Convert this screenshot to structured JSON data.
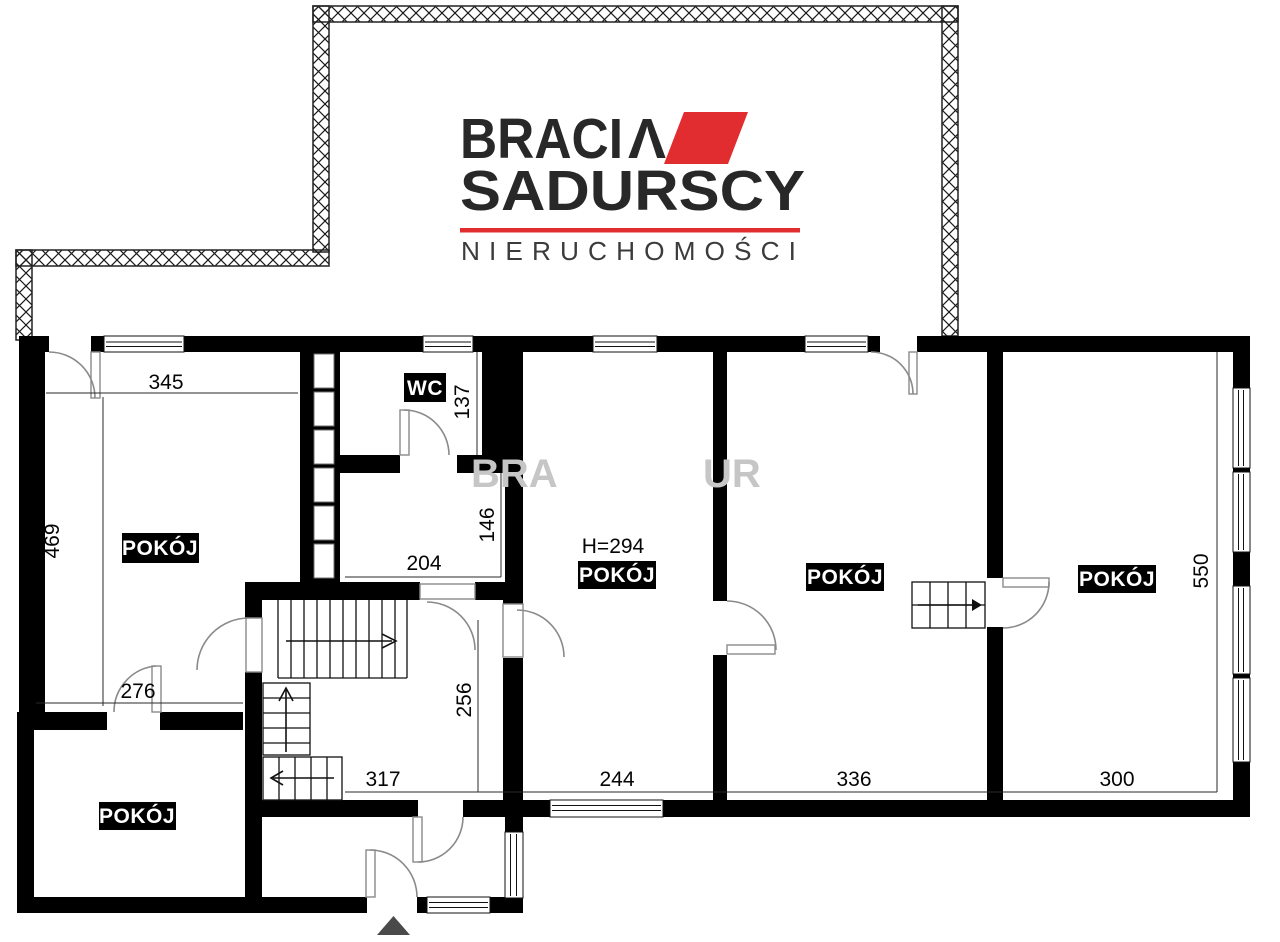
{
  "meta": {
    "wall_color": "#000000",
    "accent_color": "#e22d30",
    "watermark_color": "#c6c6c6",
    "entrance_color": "#4a4a4a",
    "logo_color": "#282828",
    "subtitle_color": "#3b3b3b"
  },
  "logo": {
    "word1": "BRACI",
    "word1_accent": "Λ",
    "word2": "SADURSCY",
    "subtitle": "NIERUCHOMOŚCI"
  },
  "watermark": {
    "full_text": "BRACIA SADURSCY",
    "fragment_left": "BRA",
    "fragment_right": "UR"
  },
  "rooms": [
    {
      "id": "room-top-left",
      "label": "POKÓJ"
    },
    {
      "id": "room-middle",
      "label": "POKÓJ",
      "height_note": "H=294"
    },
    {
      "id": "room-336",
      "label": "POKÓJ"
    },
    {
      "id": "room-right",
      "label": "POKÓJ"
    },
    {
      "id": "room-bottom-left",
      "label": "POKÓJ"
    },
    {
      "id": "wc",
      "label": "WC"
    }
  ],
  "dimensions": {
    "top_room_width": "345",
    "top_room_depth": "469",
    "bottom_room_width": "276",
    "wc_depth": "137",
    "store_depth": "146",
    "store_width": "204",
    "hall_depth": "256",
    "hall_width": "317",
    "middle_room_width": "244",
    "second_room_width": "336",
    "right_room_width": "300",
    "right_room_depth": "550"
  }
}
